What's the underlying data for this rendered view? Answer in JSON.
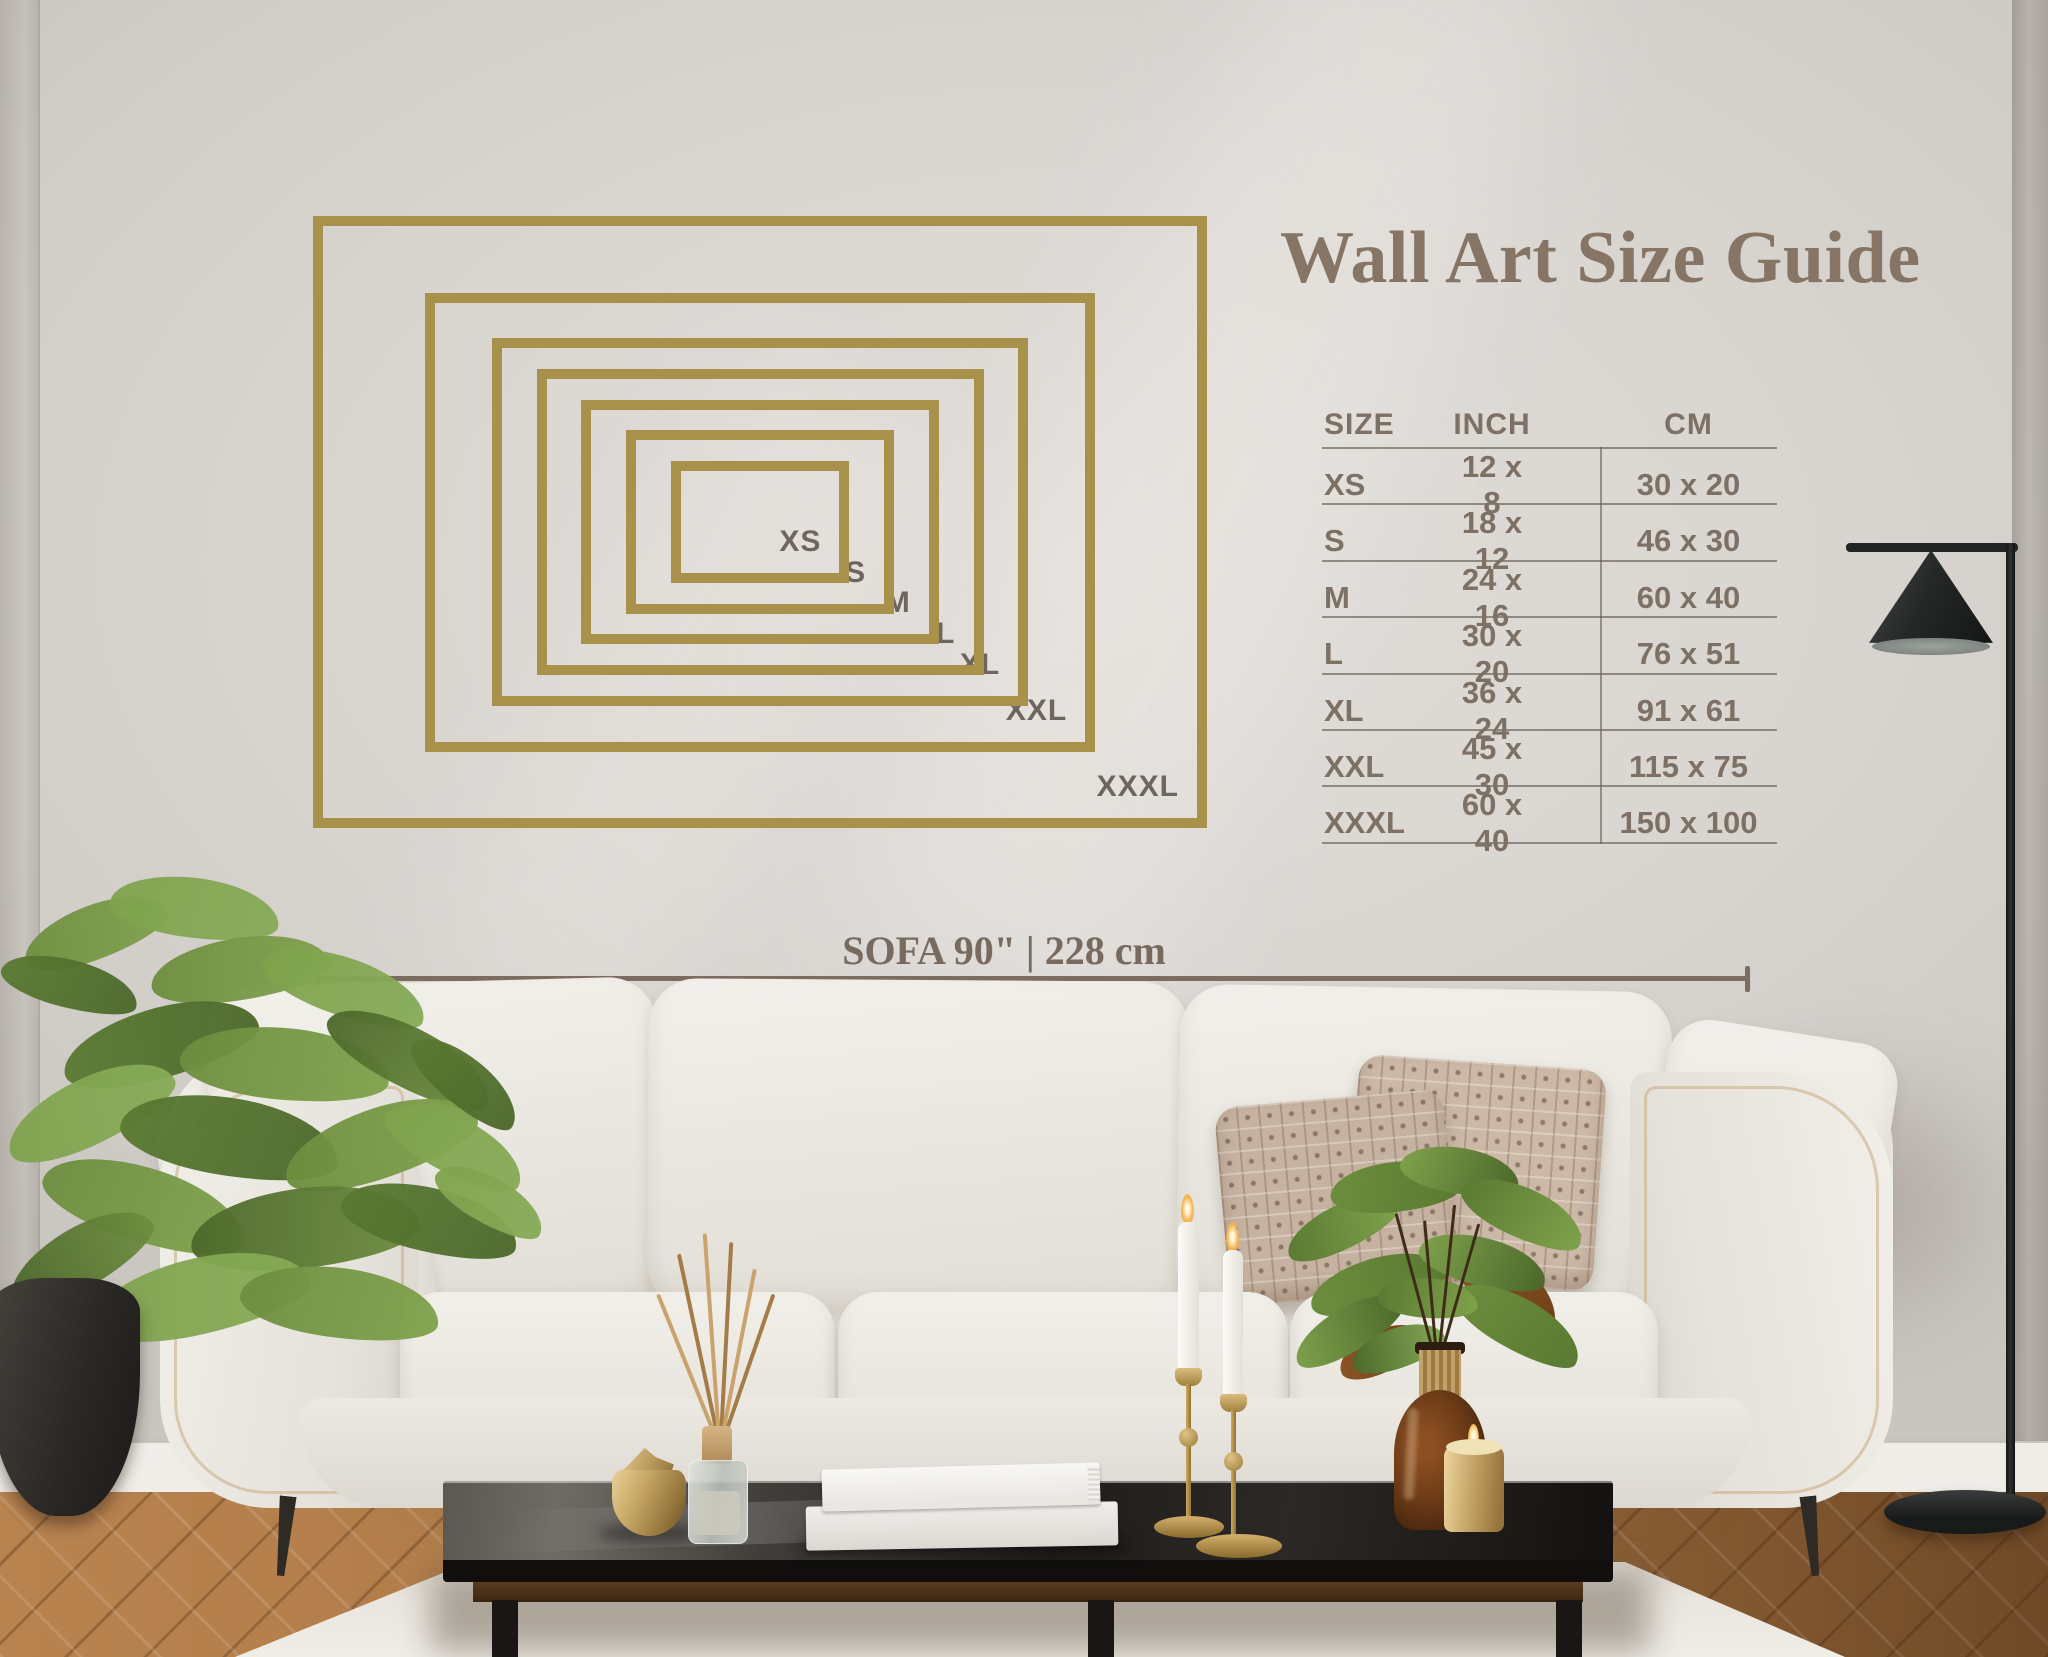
{
  "title": "Wall Art Size Guide",
  "size_guide": {
    "frame_color": "#a8914a",
    "frames": [
      {
        "label": "XS",
        "inch_w": 12,
        "inch_h": 8
      },
      {
        "label": "S",
        "inch_w": 18,
        "inch_h": 12
      },
      {
        "label": "M",
        "inch_w": 24,
        "inch_h": 16
      },
      {
        "label": "L",
        "inch_w": 30,
        "inch_h": 20
      },
      {
        "label": "XL",
        "inch_w": 36,
        "inch_h": 24
      },
      {
        "label": "XXL",
        "inch_w": 45,
        "inch_h": 30
      },
      {
        "label": "XXXL",
        "inch_w": 60,
        "inch_h": 40
      }
    ]
  },
  "table": {
    "headers": [
      "SIZE",
      "INCH",
      "CM"
    ],
    "rows": [
      [
        "XS",
        "12 x 8",
        "30 x 20"
      ],
      [
        "S",
        "18 x 12",
        "46 x 30"
      ],
      [
        "M",
        "24 x 16",
        "60 x 40"
      ],
      [
        "L",
        "30 x 20",
        "76 x 51"
      ],
      [
        "XL",
        "36 x 24",
        "91 x 61"
      ],
      [
        "XXL",
        "45 x 30",
        "115 x 75"
      ],
      [
        "XXXL",
        "60 x 40",
        "150 x 100"
      ]
    ]
  },
  "sofa_measure": {
    "label": "SOFA 90\" | 228 cm"
  },
  "colors": {
    "frame_gold": "#a8914a",
    "table_text": "#7d7064",
    "title_text": "#867565",
    "measure_text": "#776a5e"
  }
}
